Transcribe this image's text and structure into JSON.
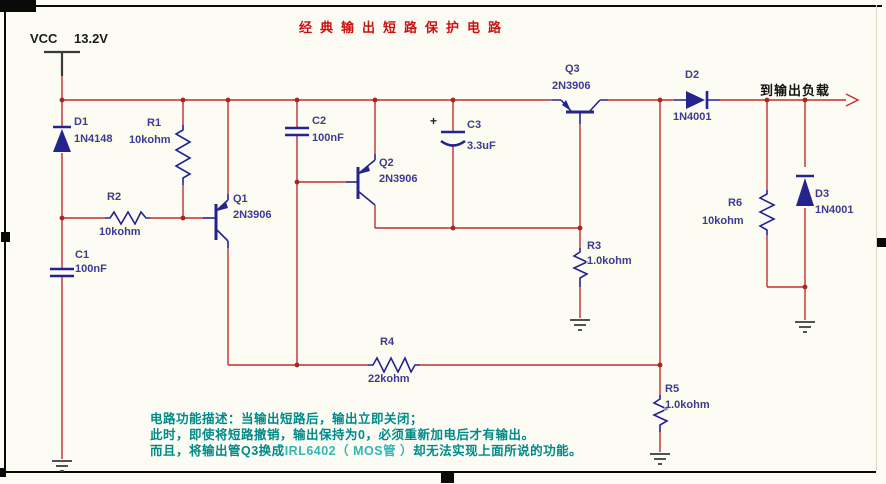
{
  "title": "经典输出短路保护电路",
  "power": {
    "net": "VCC",
    "voltage": "13.2V"
  },
  "output": {
    "label": "到输出负载"
  },
  "components": {
    "D1": {
      "ref": "D1",
      "value": "1N4148"
    },
    "D2": {
      "ref": "D2",
      "value": "1N4001"
    },
    "D3": {
      "ref": "D3",
      "value": "1N4001"
    },
    "R1": {
      "ref": "R1",
      "value": "10kohm"
    },
    "R2": {
      "ref": "R2",
      "value": "10kohm"
    },
    "R3": {
      "ref": "R3",
      "value": "1.0kohm"
    },
    "R4": {
      "ref": "R4",
      "value": "22kohm"
    },
    "R5": {
      "ref": "R5",
      "value": "1.0kohm"
    },
    "R6": {
      "ref": "R6",
      "value": "10kohm"
    },
    "C1": {
      "ref": "C1",
      "value": "100nF"
    },
    "C2": {
      "ref": "C2",
      "value": "100nF"
    },
    "C3": {
      "ref": "C3",
      "value": "3.3uF",
      "polarity": "+"
    },
    "Q1": {
      "ref": "Q1",
      "value": "2N3906"
    },
    "Q2": {
      "ref": "Q2",
      "value": "2N3906"
    },
    "Q3": {
      "ref": "Q3",
      "value": "2N3906"
    }
  },
  "description": {
    "line1": "电路功能描述：当输出短路后，输出立即关闭；",
    "line2": "此时，即使将短路撤销，输出保持为0，必须重新加电后才有输出。",
    "line3_pre": "而且，将输出管Q3换成",
    "line3_highlight": "IRL6402（ MOS管 ）",
    "line3_post": "却无法实现上面所说的功能。"
  },
  "colors": {
    "wire": "#bf3030",
    "junction": "#a82525",
    "component": "#24248f",
    "label": "#3a3aa0",
    "title": "#cc1111",
    "description": "#008a8a",
    "description_highlight": "#35b6b6"
  }
}
